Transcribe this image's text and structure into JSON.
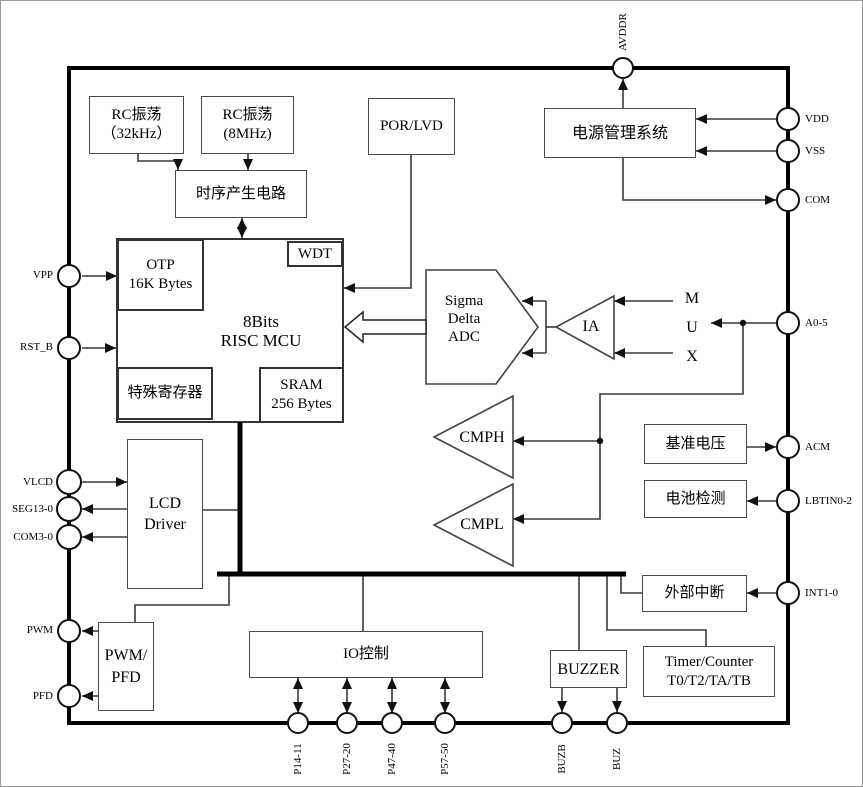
{
  "diagram_title": "8-bit RISC MCU block diagram",
  "colors": {
    "background": "#ffffff",
    "line": "#3a3a3a",
    "bus": "#000000"
  },
  "blocks": {
    "rc32k": {
      "lines": [
        "RC振荡",
        "（32kHz）"
      ]
    },
    "rc8m": {
      "lines": [
        "RC振荡",
        "(8MHz)"
      ]
    },
    "timing": {
      "lines": [
        "时序产生电路"
      ]
    },
    "por_lvd": {
      "lines": [
        "POR/LVD"
      ]
    },
    "power_mgmt": {
      "lines": [
        "电源管理系统"
      ]
    },
    "otp": {
      "lines": [
        "OTP",
        "16K Bytes"
      ]
    },
    "wdt": {
      "lines": [
        "WDT"
      ]
    },
    "mcu": {
      "lines": [
        "8Bits",
        "RISC  MCU"
      ]
    },
    "special_reg": {
      "lines": [
        "特殊寄存器"
      ]
    },
    "sram": {
      "lines": [
        "SRAM",
        "256 Bytes"
      ]
    },
    "adc": {
      "lines": [
        "Sigma",
        "Delta",
        "ADC"
      ]
    },
    "ia": {
      "lines": [
        "IA"
      ]
    },
    "mux": {
      "lines": [
        "M",
        "U",
        "X"
      ]
    },
    "cmph": {
      "lines": [
        "CMPH"
      ]
    },
    "cmpl": {
      "lines": [
        "CMPL"
      ]
    },
    "vref": {
      "lines": [
        "基准电压"
      ]
    },
    "battery_detect": {
      "lines": [
        "电池检测"
      ]
    },
    "lcd_driver": {
      "lines": [
        "LCD",
        "Driver"
      ]
    },
    "ext_int": {
      "lines": [
        "外部中断"
      ]
    },
    "pwm_pfd": {
      "lines": [
        "PWM/",
        "PFD"
      ]
    },
    "io_ctrl": {
      "lines": [
        "IO控制"
      ]
    },
    "buzzer": {
      "lines": [
        "BUZZER"
      ]
    },
    "timer": {
      "lines": [
        "Timer/Counter",
        "T0/T2/TA/TB"
      ]
    }
  },
  "pins": {
    "top": [
      "AVDDR"
    ],
    "left": [
      "VPP",
      "RST_B",
      "VLCD",
      "SEG13-0",
      "COM3-0",
      "PWM",
      "PFD"
    ],
    "right": [
      "VDD",
      "VSS",
      "COM",
      "A0-5",
      "ACM",
      "LBTIN0-2",
      "INT1-0"
    ],
    "bottom": [
      "P14-11",
      "P27-20",
      "P47-40",
      "P57-50",
      "BUZB",
      "BUZ"
    ]
  }
}
